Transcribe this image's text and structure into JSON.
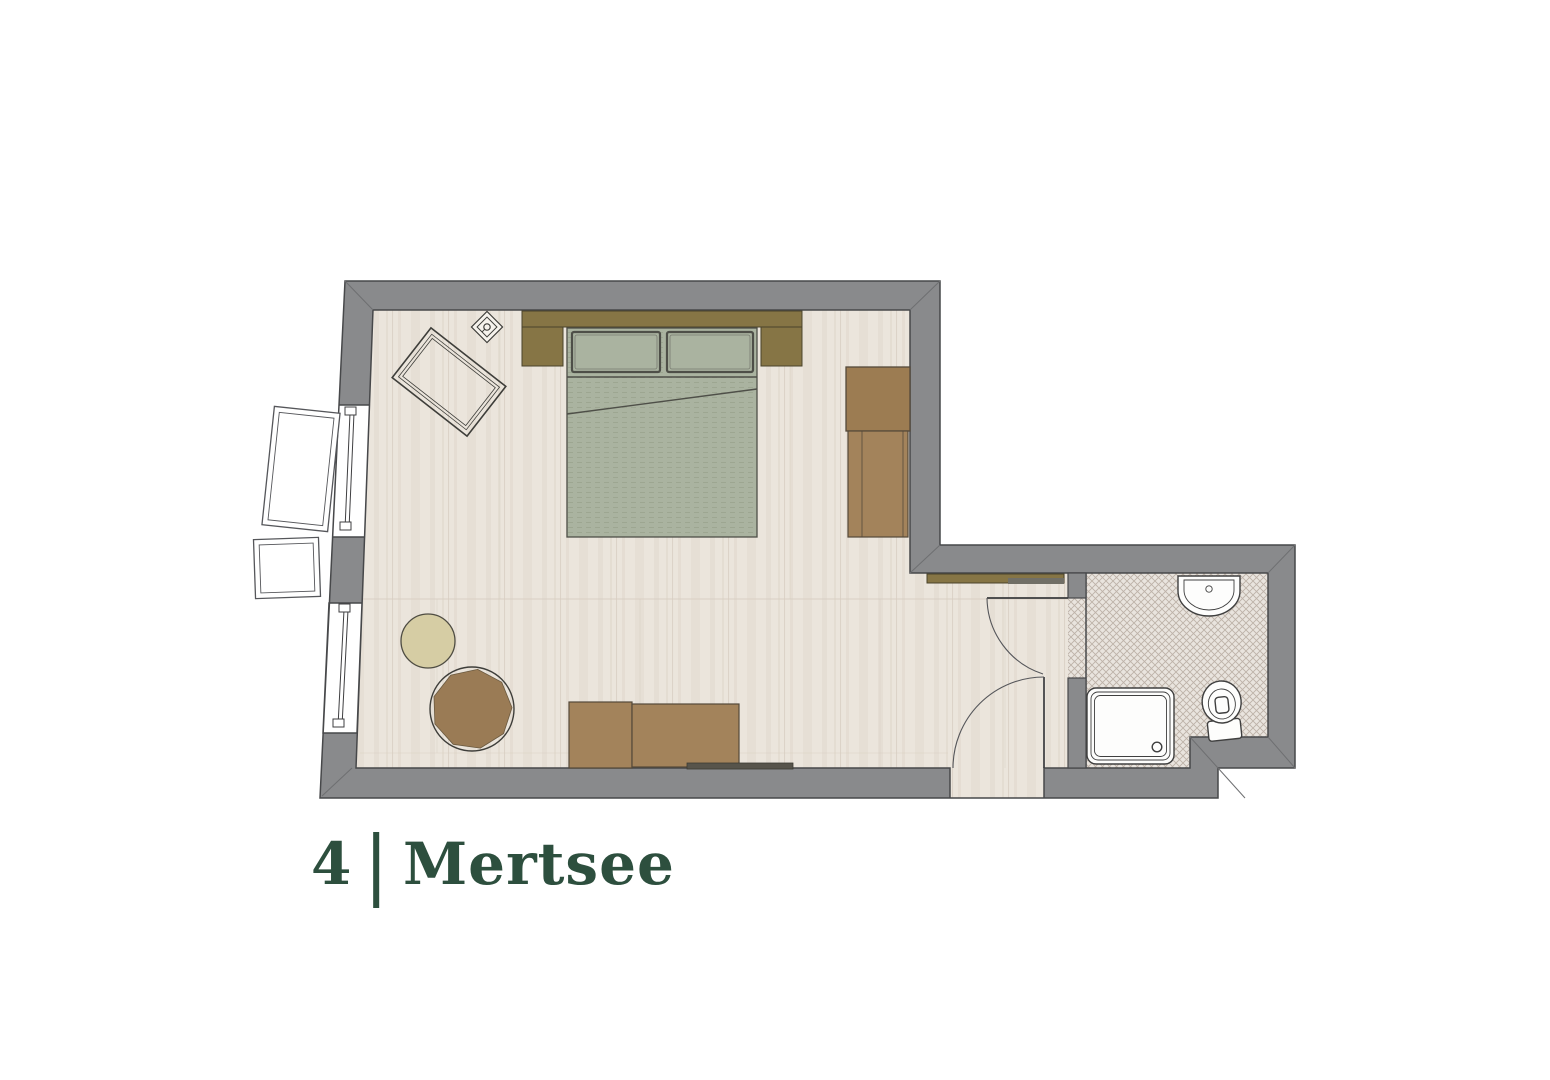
{
  "title": {
    "number": "4",
    "separator": "|",
    "name": "Mertsee"
  },
  "palette": {
    "wall": "#898A8C",
    "wallEdge": "#47484A",
    "wallMiter": "#6E6F71",
    "floorWood": "#EBE5DC",
    "floorGrain": "#DFD7CB",
    "plankLine": "#D6CCBF",
    "tileBase": "#E9E4DE",
    "tileLine": "#BDB2A8",
    "bedGreen": "#AAB3A0",
    "bedLine": "#9DA691",
    "outlineDark": "#4E4F48",
    "olive": "#867545",
    "oliveEdge": "#4A422A",
    "brown": "#A3835B",
    "brownDark": "#9C7C52",
    "furnitureEdge": "#54493A",
    "pouf": "#9A7B55",
    "beige": "#D6CDA4",
    "rugBase": "#BDC4AE",
    "rugWeave": "#9CA48C",
    "rugEdge": "#3E3E3A",
    "fixtureFill": "#FDFDFC",
    "fixtureEdge": "#3F3F3F",
    "doorArc": "#55565A",
    "radiator": "#57544B",
    "rackMetal": "#716F66",
    "titleGreen": "#2D4F3E",
    "background": "#FFFFFF"
  },
  "rooms": [
    {
      "name": "bedroom",
      "floor": "wood-plank"
    },
    {
      "name": "bathroom",
      "floor": "mosaic-tile"
    }
  ],
  "furniture": [
    "rug",
    "ceiling-lamp",
    "double-bed",
    "headboard",
    "pillow-left",
    "pillow-right",
    "nightstand-left",
    "nightstand-right",
    "wardrobe",
    "sideboard",
    "luggage-rack",
    "bench-left",
    "bench-right",
    "radiator",
    "round-side-table",
    "pouf",
    "window-top",
    "window-bottom",
    "entry-door",
    "bathroom-door",
    "sink",
    "toilet",
    "shower"
  ]
}
